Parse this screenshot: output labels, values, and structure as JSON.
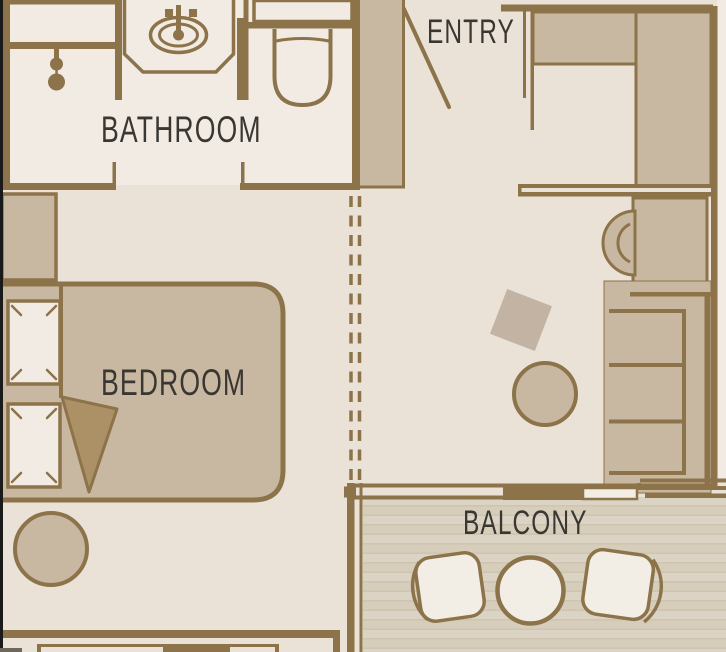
{
  "labels": {
    "bathroom": "BATHROOM",
    "entry": "ENTRY",
    "bedroom": "BEDROOM",
    "balcony": "BALCONY"
  },
  "colors": {
    "wall": "#8C7349",
    "floor_main": "#EAE2D7",
    "floor_light": "#F1EBE3",
    "furniture": "#C8B8A1",
    "blanket": "#AC9166",
    "cream": "#F2EDE5",
    "deck_light": "#DBD3C3",
    "deck_mid": "#D6CDBB",
    "deck_line": "#CEC4B1",
    "text": "#3A3733",
    "edge": "#1A1A1A"
  }
}
